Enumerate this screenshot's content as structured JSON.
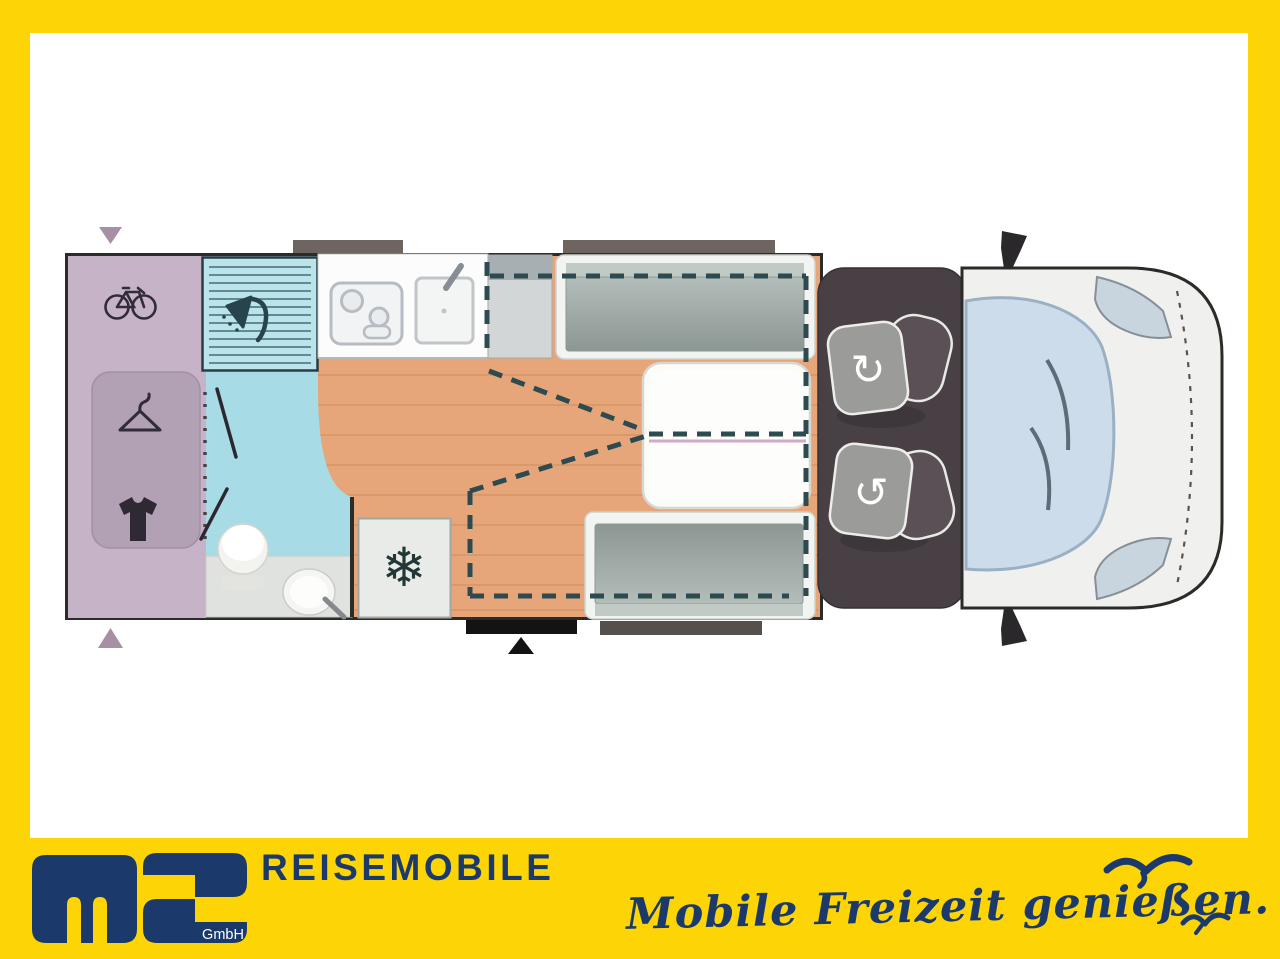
{
  "branding": {
    "logo_monogram": "ms",
    "logo_gmbh": "GmbH",
    "company_name": "REISEMOBILE",
    "tagline": "Mobile Freizeit genießen."
  },
  "colors": {
    "frame_yellow": "#fdd506",
    "brand_navy": "#1b3a6b",
    "floor_wood": "#e6a67a",
    "garage_mauve": "#c7b3c7",
    "bathroom_blue": "#a7dce7",
    "bench_gray": "#98a39f",
    "cab_brown": "#494046",
    "dashed_outline": "#2c4a50",
    "marker_mauve": "#a790a4"
  },
  "floorplan": {
    "type": "motorhome-top-view",
    "icons": [
      "bicycle",
      "clothes-hanger",
      "t-shirt",
      "shower",
      "toilet",
      "washbasin",
      "stove",
      "sink",
      "snowflake",
      "swivel-seat-arrow",
      "entry-arrow",
      "seagull"
    ],
    "areas": [
      "rear-garage",
      "wardrobe",
      "bathroom",
      "shower-cubicle",
      "kitchen",
      "refrigerator",
      "dinette-with-table",
      "drop-down-bed-outline",
      "entry-step",
      "driver-cab",
      "windshield"
    ]
  }
}
